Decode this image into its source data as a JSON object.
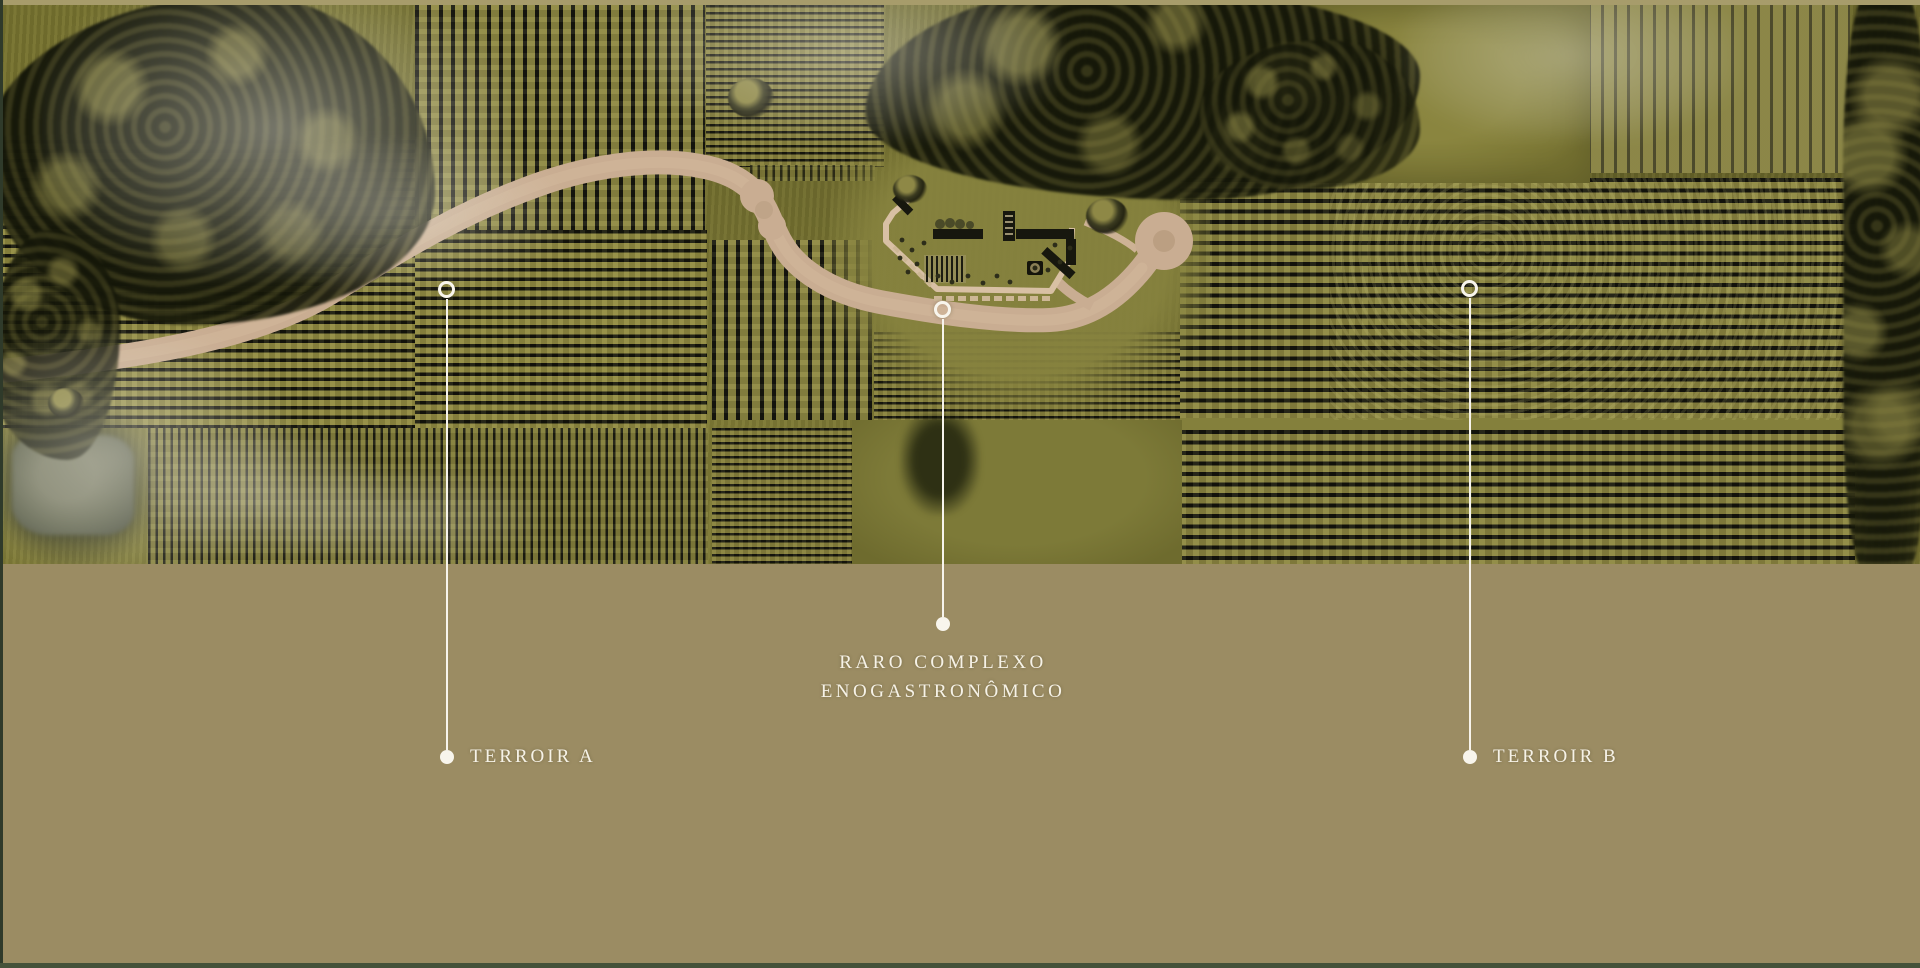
{
  "markers": {
    "terroir_a": {
      "label": "TERROIR A"
    },
    "complexo": {
      "line1": "RARO COMPLEXO",
      "line2": "ENOGASTRONÔMICO"
    },
    "terroir_b": {
      "label": "TERROIR B"
    }
  },
  "colors": {
    "background": "#9b8c63",
    "label_text": "#f6f2e7",
    "marker_line": "#f7f4ec",
    "road": "#c9ad92",
    "field_olive": "#74702f",
    "vine_row_dark": "#15150d",
    "vine_row_light": "#8e8840",
    "tree_canopy": "#1d2010",
    "pond": "#626650",
    "top_edge_strip": "#a79c6b",
    "border_green": "#3c4a33"
  }
}
